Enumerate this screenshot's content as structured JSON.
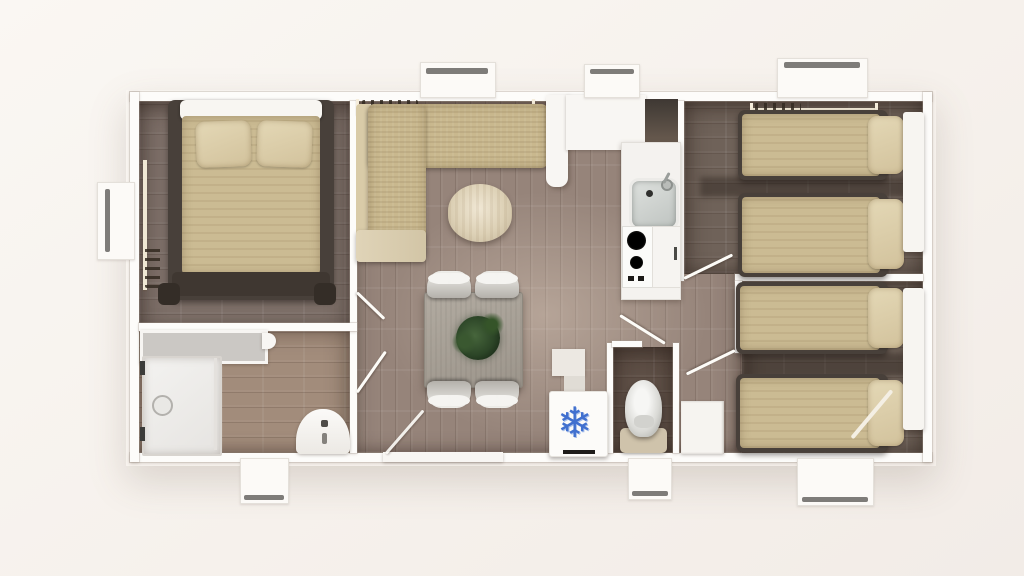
{
  "scene": {
    "type": "floor-plan",
    "view": "top-down-3d-render",
    "rooms": [
      "master-bedroom",
      "bathroom",
      "living-dining",
      "kitchen",
      "wc",
      "bedroom-2",
      "bedroom-3",
      "hallway"
    ]
  },
  "icons": {
    "freezer_snowflake": "❄"
  },
  "colors": {
    "background": "#f6f2ee",
    "walls": "#fdfcfa",
    "floor_master": "#7d6f68",
    "floor_bathroom": "#a28c7b",
    "floor_living": "#96847a",
    "floor_bedroom2": "#6f6259",
    "floor_bedroom3": "#6d6057",
    "floor_wc": "#5f5047",
    "mattress_beige": "#cbbb93",
    "sofa_beige": "#c9b88e",
    "round_table": "#ddd1b6",
    "dining_table": "#a7a096",
    "plant_green": "#2c4527",
    "snowflake_blue": "#4170cf",
    "kitchen_counter_dark": "#4a423b",
    "toilet_base_tan": "#cfc3ab",
    "window_bar_gray": "#7e7c79"
  }
}
